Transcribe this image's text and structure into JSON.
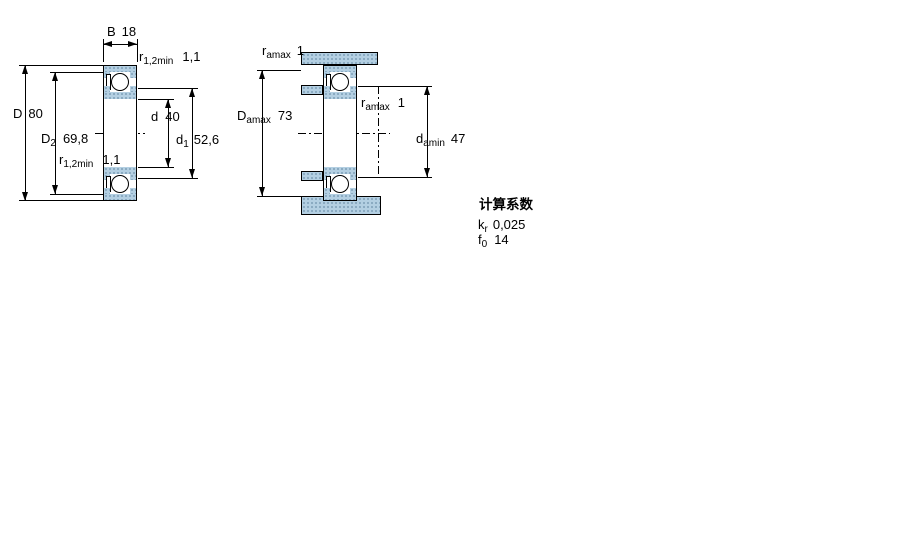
{
  "colors": {
    "hatch_fill": "#b3cfe2",
    "hatch_dot": "#7e9fb8",
    "line": "#000000"
  },
  "left_view": {
    "b": {
      "base": "B",
      "sub": "",
      "value": "18"
    },
    "r_top": {
      "base": "r",
      "sub": "1,2min",
      "value": "1,1"
    },
    "d_outer": {
      "base": "D",
      "sub": "",
      "value": "80"
    },
    "d2": {
      "base": "D",
      "sub": "2",
      "value": "69,8"
    },
    "r_bottom": {
      "base": "r",
      "sub": "1,2min",
      "value": "1,1"
    },
    "d_bore": {
      "base": "d",
      "sub": "",
      "value": "40"
    },
    "d1": {
      "base": "d",
      "sub": "1",
      "value": "52,6"
    }
  },
  "right_view": {
    "ra_top": {
      "base": "r",
      "sub": "amax",
      "value": "1"
    },
    "da_housing": {
      "base": "D",
      "sub": "amax",
      "value": "73"
    },
    "ra_shaft": {
      "base": "r",
      "sub": "amax",
      "value": "1"
    },
    "da_shaft": {
      "base": "d",
      "sub": "amin",
      "value": "47"
    }
  },
  "notes": {
    "title": "计算系数",
    "kr": {
      "base": "k",
      "sub": "r",
      "value": "0,025"
    },
    "f0": {
      "base": "f",
      "sub": "0",
      "value": "14"
    }
  }
}
